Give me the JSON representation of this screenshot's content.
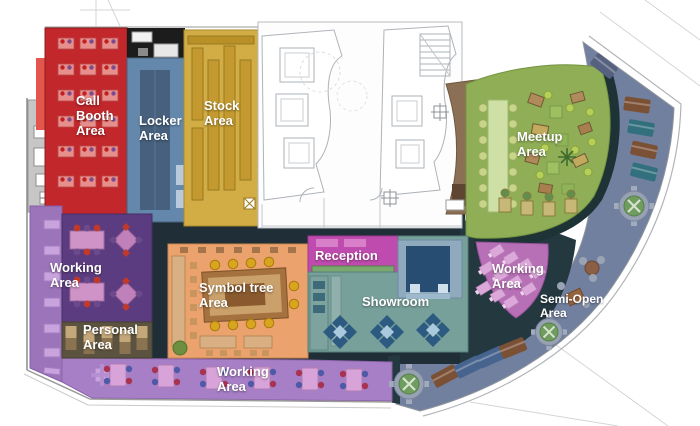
{
  "plan": {
    "name": "Office floor plan",
    "areas": {
      "call_booth": {
        "label": [
          "Call",
          "Booth",
          "Area"
        ],
        "color": "#c1272b"
      },
      "locker": {
        "label": [
          "Locker",
          "Area"
        ],
        "color": "#6488ac"
      },
      "stock": {
        "label": [
          "Stock",
          "Area"
        ],
        "color": "#d2ac45"
      },
      "meetup": {
        "label": [
          "Meetup",
          "Area"
        ],
        "color": "#8fae56"
      },
      "working_left": {
        "label": [
          "Working",
          "Area"
        ],
        "color": "#5c3c80"
      },
      "personal": {
        "label": [
          "Personal",
          "Area"
        ],
        "color": "#5b5340"
      },
      "symbol_tree": {
        "label": [
          "Symbol tree",
          "Area"
        ],
        "color": "#eba26d"
      },
      "reception": {
        "label": [
          "Reception"
        ],
        "color": "#bf4bae"
      },
      "showroom": {
        "label": [
          "Showroom"
        ],
        "color": "#77a09b"
      },
      "working_bottom": {
        "label": [
          "Working",
          "Area"
        ],
        "color": "#a77fc6"
      },
      "working_right": {
        "label": [
          "Working",
          "Area"
        ],
        "color": "#b76fb5"
      },
      "semi_open": {
        "label": [
          "Semi-Open",
          "Area"
        ],
        "color": "#7280a0"
      }
    }
  }
}
